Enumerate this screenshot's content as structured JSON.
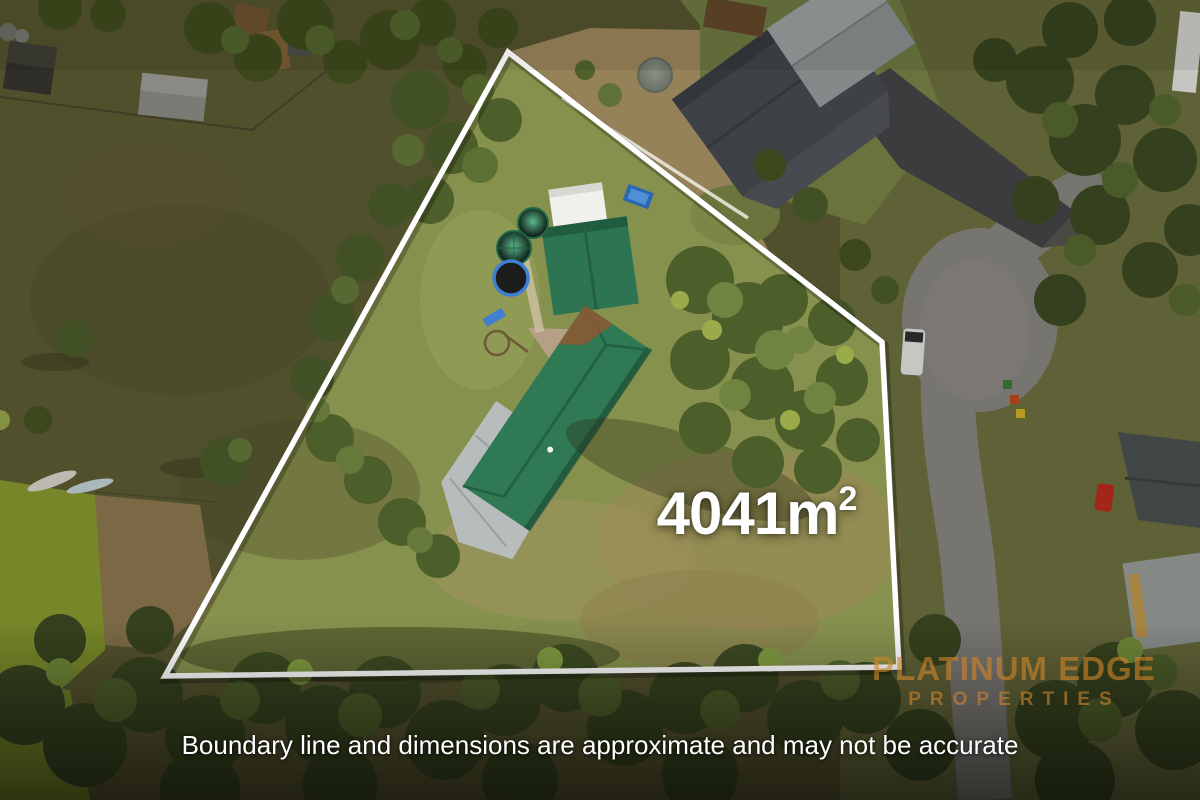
{
  "page": {
    "type": "real-estate-aerial-photo"
  },
  "overlay": {
    "area_label": {
      "value": "4041",
      "unit": "m",
      "superscript": "2"
    },
    "watermark": {
      "line1": "PLATINUM EDGE",
      "line2": "PROPERTIES"
    },
    "disclaimer": "Boundary line and dimensions are approximate and may not be accurate"
  },
  "colors": {
    "boundary_line": "#ffffff",
    "area_text": "#ffffff",
    "watermark_text": "#ce8428",
    "disclaimer_text": "#ffffff",
    "main_roof_green": "#2f7a55",
    "veranda_gray": "#b7bdbd",
    "pool_item_blue": "#2a67b5",
    "paddock_olive": "#5d5c33",
    "yard_green": "#8a9150",
    "road_gravel": "#8b8884",
    "asphalt_dark": "#454548"
  }
}
